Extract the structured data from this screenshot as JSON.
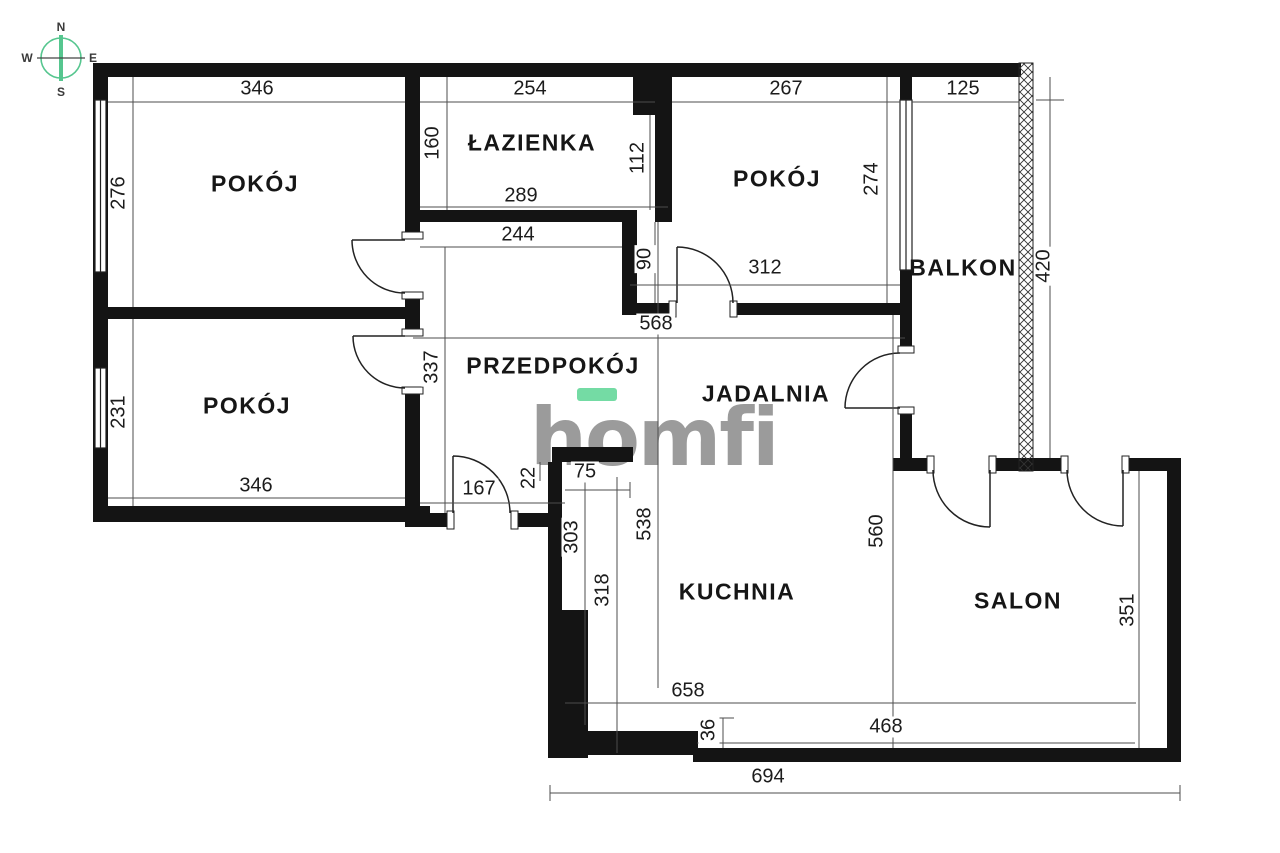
{
  "title": "apartment-floor-plan",
  "compass": {
    "north": "N",
    "south": "S",
    "east": "E",
    "west": "W"
  },
  "logo": {
    "text": "homfi",
    "accent_color": "#74dba4",
    "text_color": "#9b9b9b"
  },
  "colors": {
    "wall": "#141414",
    "dimension_line": "#4d4d4d",
    "label_text": "#1c1c1c",
    "compass_green": "#56c68f",
    "background": "#ffffff"
  },
  "rooms": [
    {
      "label": "POKÓJ",
      "x": 255,
      "y": 184
    },
    {
      "label": "ŁAZIENKA",
      "x": 532,
      "y": 143
    },
    {
      "label": "POKÓJ",
      "x": 777,
      "y": 179
    },
    {
      "label": "BALKON",
      "x": 963,
      "y": 268
    },
    {
      "label": "POKÓJ",
      "x": 247,
      "y": 406
    },
    {
      "label": "PRZEDPOKÓJ",
      "x": 553,
      "y": 366
    },
    {
      "label": "JADALNIA",
      "x": 766,
      "y": 394
    },
    {
      "label": "KUCHNIA",
      "x": 737,
      "y": 592
    },
    {
      "label": "SALON",
      "x": 1018,
      "y": 601
    }
  ],
  "dimensions": [
    {
      "value": "346",
      "x": 257,
      "y": 89,
      "vertical": false
    },
    {
      "value": "254",
      "x": 530,
      "y": 89,
      "vertical": false
    },
    {
      "value": "267",
      "x": 786,
      "y": 89,
      "vertical": false
    },
    {
      "value": "125",
      "x": 963,
      "y": 89,
      "vertical": false
    },
    {
      "value": "276",
      "x": 119,
      "y": 193,
      "vertical": true
    },
    {
      "value": "160",
      "x": 433,
      "y": 143,
      "vertical": true
    },
    {
      "value": "112",
      "x": 638,
      "y": 158,
      "vertical": true
    },
    {
      "value": "289",
      "x": 521,
      "y": 196,
      "vertical": false
    },
    {
      "value": "244",
      "x": 518,
      "y": 235,
      "vertical": false
    },
    {
      "value": "274",
      "x": 872,
      "y": 179,
      "vertical": true
    },
    {
      "value": "90",
      "x": 645,
      "y": 259,
      "vertical": true
    },
    {
      "value": "312",
      "x": 765,
      "y": 268,
      "vertical": false
    },
    {
      "value": "420",
      "x": 1044,
      "y": 266,
      "vertical": true
    },
    {
      "value": "568",
      "x": 656,
      "y": 324,
      "vertical": false
    },
    {
      "value": "337",
      "x": 432,
      "y": 367,
      "vertical": true
    },
    {
      "value": "231",
      "x": 119,
      "y": 412,
      "vertical": true
    },
    {
      "value": "346",
      "x": 256,
      "y": 486,
      "vertical": false
    },
    {
      "value": "167",
      "x": 479,
      "y": 489,
      "vertical": false
    },
    {
      "value": "22",
      "x": 529,
      "y": 478,
      "vertical": true
    },
    {
      "value": "75",
      "x": 585,
      "y": 472,
      "vertical": false
    },
    {
      "value": "303",
      "x": 572,
      "y": 537,
      "vertical": true
    },
    {
      "value": "318",
      "x": 603,
      "y": 590,
      "vertical": true
    },
    {
      "value": "538",
      "x": 645,
      "y": 524,
      "vertical": true
    },
    {
      "value": "560",
      "x": 877,
      "y": 531,
      "vertical": true
    },
    {
      "value": "351",
      "x": 1128,
      "y": 610,
      "vertical": true
    },
    {
      "value": "658",
      "x": 688,
      "y": 691,
      "vertical": false
    },
    {
      "value": "36",
      "x": 709,
      "y": 730,
      "vertical": true
    },
    {
      "value": "468",
      "x": 886,
      "y": 727,
      "vertical": false
    },
    {
      "value": "694",
      "x": 768,
      "y": 777,
      "vertical": false
    }
  ]
}
